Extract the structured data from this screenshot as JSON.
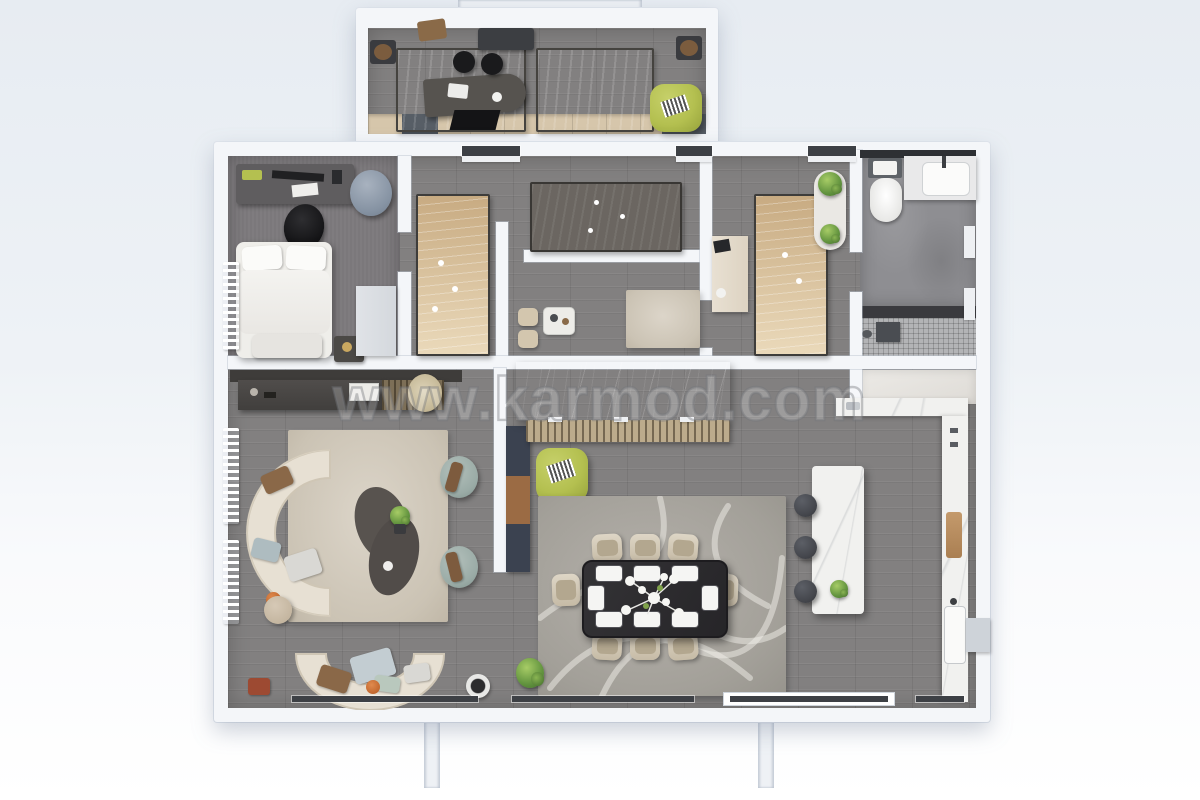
{
  "watermark": {
    "text": "www.karmod.com"
  },
  "palette": {
    "background_top": "#e7ecf2",
    "wall": "#f4f6f9",
    "floor_wood": "#828080",
    "accent_lime": "#b4c050",
    "sofa_cream": "#e7e0d3",
    "rug_beige": "#bcb09a",
    "marble_dark": "#333338",
    "island_white": "#f1f1ef"
  }
}
